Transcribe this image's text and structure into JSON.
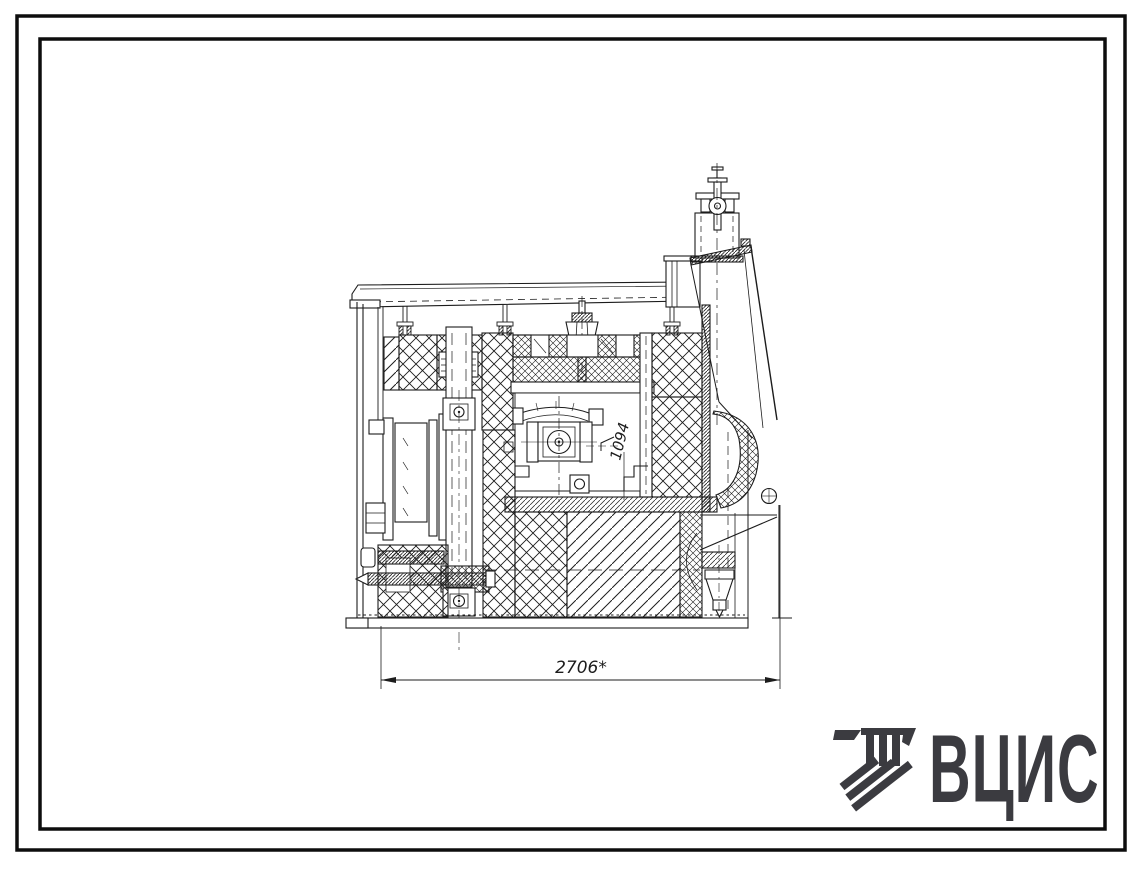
{
  "sheet": {
    "width": 1139,
    "height": 869,
    "background": "#ffffff",
    "frame_color": "#0d0d0d"
  },
  "drawing": {
    "kind": "furnace-cross-section",
    "line_color": "#1c1c1c",
    "dimensions": {
      "width_label": "2706*",
      "height_label": "1094"
    }
  },
  "logo": {
    "text": "ВЦИС",
    "color": "#3b3b40",
    "symbol_icon": "hatched-stripe-emblem"
  }
}
